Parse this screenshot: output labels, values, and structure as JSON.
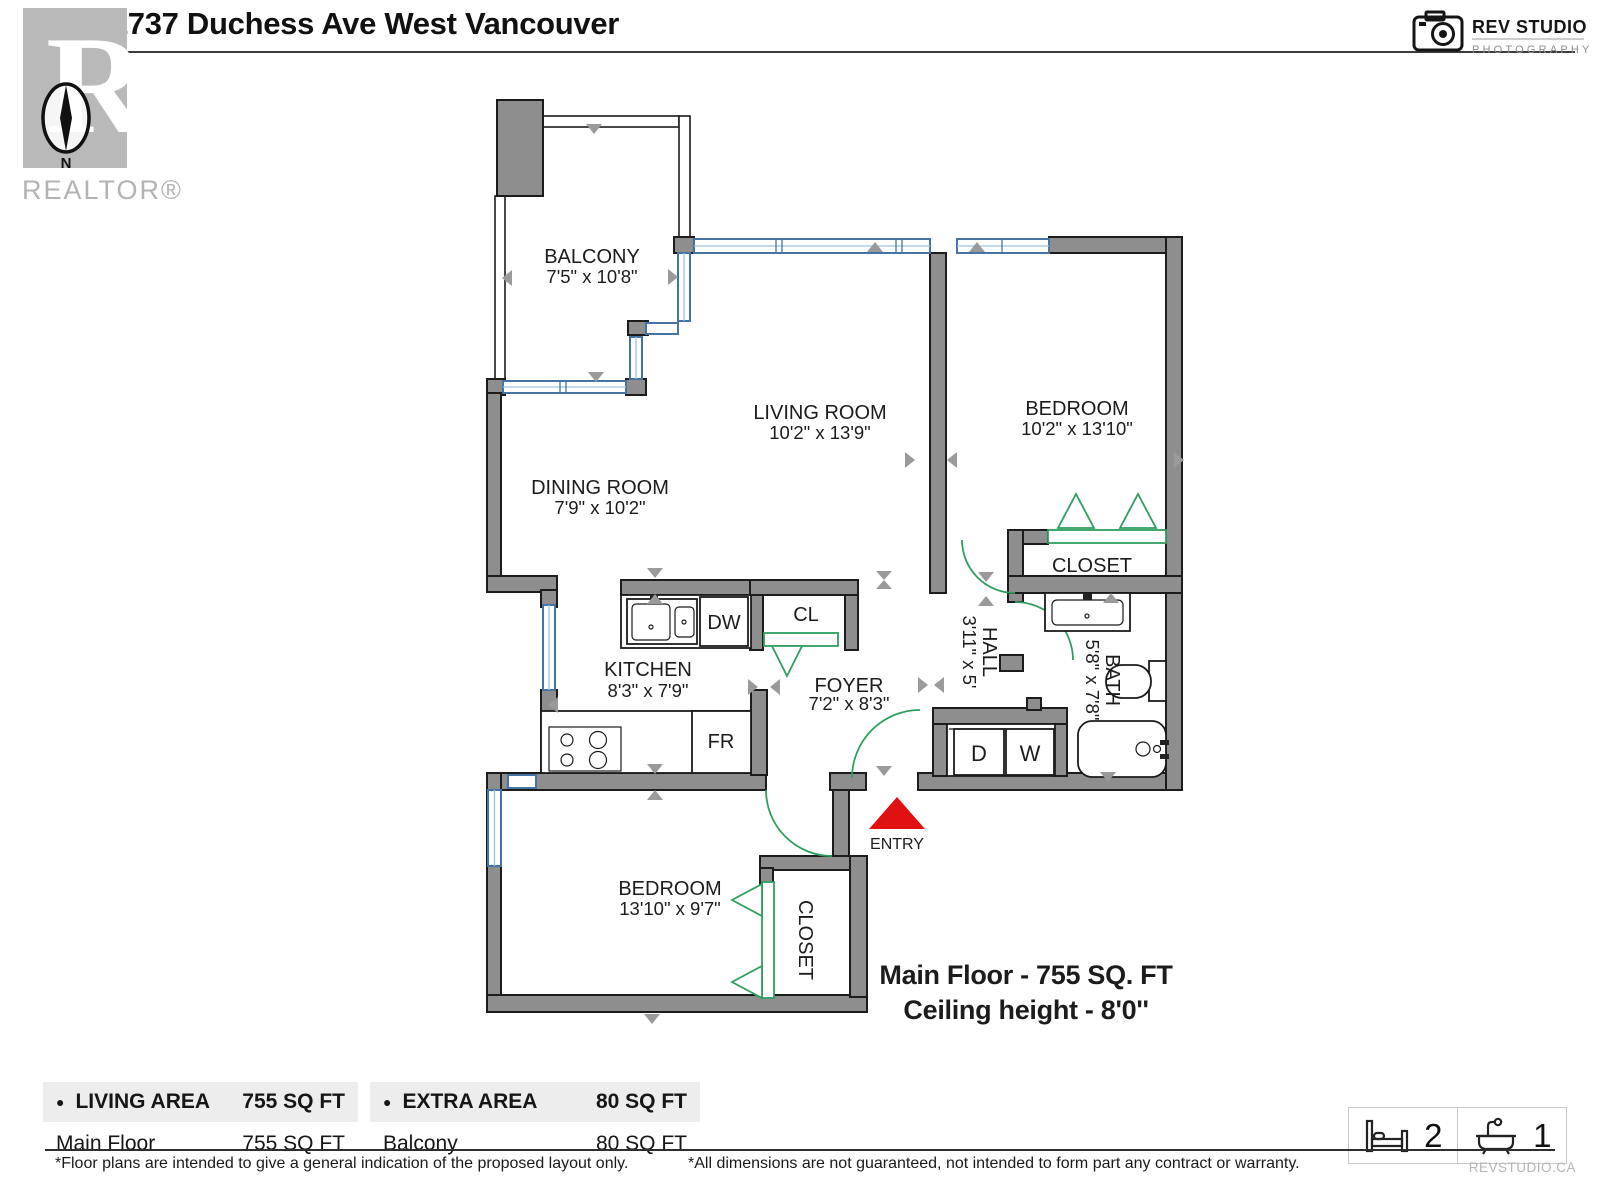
{
  "header": {
    "title": "502-1737 Duchess Ave West Vancouver",
    "realtor": {
      "letter": "R",
      "north": "N",
      "brand": "REALTOR®"
    },
    "studio": {
      "name": "REV STUDIO",
      "tagline": "PHOTOGRAPHY"
    }
  },
  "plan": {
    "balcony": {
      "name": "BALCONY",
      "dims": "7'5\" x 10'8\""
    },
    "living": {
      "name": "LIVING ROOM",
      "dims": "10'2\" x 13'9\""
    },
    "bedroom1": {
      "name": "BEDROOM",
      "dims": "10'2\" x 13'10\""
    },
    "dining": {
      "name": "DINING ROOM",
      "dims": "7'9\" x 10'2\""
    },
    "closet1": {
      "name": "CLOSET"
    },
    "kitchen": {
      "name": "KITCHEN",
      "dims": "8'3\" x 7'9\""
    },
    "cl": {
      "name": "CL"
    },
    "foyer": {
      "name": "FOYER",
      "dims": "7'2\" x 8'3\""
    },
    "hall": {
      "name": "HALL",
      "dims": "3'11\" x 5'"
    },
    "bath": {
      "name": "BATH",
      "dims": "5'8\" x 7'8\""
    },
    "bedroom2": {
      "name": "BEDROOM",
      "dims": "13'10\" x 9'7\""
    },
    "closet2": {
      "name": "CLOSET"
    },
    "fixtures": {
      "dw": "DW",
      "fr": "FR",
      "d": "D",
      "w": "W"
    },
    "entry": "ENTRY",
    "summary": {
      "line1": "Main Floor - 755 SQ. FT",
      "line2": "Ceiling height - 8'0''"
    }
  },
  "area_tables": {
    "living": {
      "bullet": "●",
      "title": "LIVING AREA",
      "total": "755 SQ FT",
      "rows": [
        {
          "label": "Main Floor",
          "value": "755  SQ FT"
        }
      ]
    },
    "extra": {
      "bullet": "●",
      "title": "EXTRA AREA",
      "total": "80 SQ FT",
      "rows": [
        {
          "label": "Balcony",
          "value": "80 SQ FT"
        }
      ]
    }
  },
  "stats": {
    "beds": "2",
    "baths": "1"
  },
  "footer": {
    "note_left": "*Floor plans are intended to give a general indication of the proposed layout only.",
    "note_right": "*All dimensions are not guaranteed, not intended to form part any contract or warranty.",
    "site": "REVSTUDIO.CA"
  },
  "colors": {
    "wall": "#8e8e8e",
    "window_blue": "#4474a4",
    "door_green": "#2f9e5f",
    "entry_red": "#e01111",
    "marker_gray": "#9a9a9a",
    "table_header_bg": "#ededed"
  }
}
